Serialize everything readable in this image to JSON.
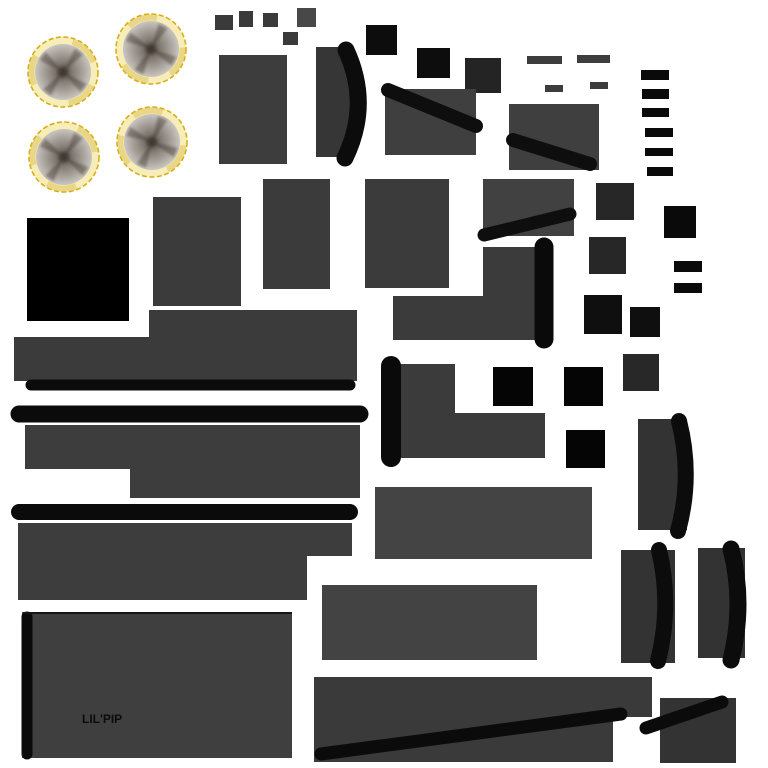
{
  "meta": {
    "width": 768,
    "height": 768,
    "background": "#ffffff"
  },
  "label": {
    "text": "LIL'PIP",
    "x": 82,
    "y": 713,
    "color": "#0c0c0c"
  },
  "palette": {
    "panel_gray": "#3b3b3b",
    "panel_gray_light": "#444444",
    "panel_gray_dark": "#333333",
    "black": "#0a0a0a",
    "pure_black": "#000000",
    "rim_yellow": "#d9ae14",
    "rim_cream": "#f6edb9",
    "rim_gold": "#dfc35e"
  },
  "wheel_style": {
    "rim_stroke": "#d9ae14",
    "rim_fill": "#f6edb9",
    "rim_shade": "#dfc35e",
    "spoke": "rgba(56,46,40,0.42)",
    "hub": "rgba(58,48,40,0.85)",
    "disc_stops": [
      [
        "0%",
        "#68615a"
      ],
      [
        "38%",
        "#867f78"
      ],
      [
        "72%",
        "#aaa49e"
      ],
      [
        "100%",
        "#c9c5c0"
      ]
    ]
  },
  "wheels": [
    {
      "cx": 63,
      "cy": 72,
      "r": 35,
      "spoke_rot": 38
    },
    {
      "cx": 151,
      "cy": 49,
      "r": 35,
      "spoke_rot": 28
    },
    {
      "cx": 64,
      "cy": 157,
      "r": 35,
      "spoke_rot": 34
    },
    {
      "cx": 152,
      "cy": 142,
      "r": 35,
      "spoke_rot": 24
    }
  ],
  "rects": [
    {
      "name": "chip-square-1",
      "x": 215,
      "y": 15,
      "w": 18,
      "h": 15,
      "color": "#3a3a3a"
    },
    {
      "name": "chip-square-2",
      "x": 239,
      "y": 11,
      "w": 14,
      "h": 16,
      "color": "#3a3a3a"
    },
    {
      "name": "chip-square-3",
      "x": 263,
      "y": 13,
      "w": 15,
      "h": 14,
      "color": "#3a3a3a"
    },
    {
      "name": "chip-square-4",
      "x": 297,
      "y": 8,
      "w": 19,
      "h": 19,
      "color": "#484848"
    },
    {
      "name": "chip-square-5",
      "x": 283,
      "y": 32,
      "w": 15,
      "h": 13,
      "color": "#3a3a3a"
    },
    {
      "name": "panel-a",
      "x": 219,
      "y": 55,
      "w": 68,
      "h": 109,
      "color": "#3d3d3d"
    },
    {
      "name": "crescent-b-body",
      "x": 316,
      "y": 47,
      "w": 37,
      "h": 110,
      "color": "#363636"
    },
    {
      "name": "black-square-c1",
      "x": 366,
      "y": 25,
      "w": 31,
      "h": 30,
      "color": "#0d0d0d"
    },
    {
      "name": "black-square-c2",
      "x": 417,
      "y": 48,
      "w": 33,
      "h": 30,
      "color": "#0d0d0d"
    },
    {
      "name": "dark-square-c3",
      "x": 465,
      "y": 58,
      "w": 36,
      "h": 35,
      "color": "#242424"
    },
    {
      "name": "panel-d",
      "x": 385,
      "y": 89,
      "w": 91,
      "h": 66,
      "color": "#3f3f3f"
    },
    {
      "name": "panel-e",
      "x": 509,
      "y": 104,
      "w": 90,
      "h": 66,
      "color": "#3f3f3f"
    },
    {
      "name": "thin-bar-1",
      "x": 527,
      "y": 56,
      "w": 35,
      "h": 8,
      "color": "#3d3d3d"
    },
    {
      "name": "thin-bar-2",
      "x": 577,
      "y": 55,
      "w": 33,
      "h": 8,
      "color": "#3d3d3d"
    },
    {
      "name": "thin-bar-3",
      "x": 545,
      "y": 85,
      "w": 18,
      "h": 7,
      "color": "#3d3d3d"
    },
    {
      "name": "thin-bar-4",
      "x": 590,
      "y": 82,
      "w": 18,
      "h": 7,
      "color": "#3d3d3d"
    },
    {
      "name": "vent-bar-1",
      "x": 641,
      "y": 70,
      "w": 28,
      "h": 10,
      "color": "#0a0a0a"
    },
    {
      "name": "vent-bar-2",
      "x": 642,
      "y": 89,
      "w": 27,
      "h": 10,
      "color": "#0a0a0a"
    },
    {
      "name": "vent-bar-3",
      "x": 642,
      "y": 108,
      "w": 27,
      "h": 9,
      "color": "#0a0a0a"
    },
    {
      "name": "vent-bar-4",
      "x": 645,
      "y": 128,
      "w": 28,
      "h": 9,
      "color": "#0a0a0a"
    },
    {
      "name": "vent-bar-5",
      "x": 645,
      "y": 148,
      "w": 28,
      "h": 8,
      "color": "#0a0a0a"
    },
    {
      "name": "vent-bar-6",
      "x": 647,
      "y": 167,
      "w": 26,
      "h": 9,
      "color": "#0a0a0a"
    },
    {
      "name": "black-square-f",
      "x": 664,
      "y": 206,
      "w": 32,
      "h": 32,
      "color": "#0a0a0a"
    },
    {
      "name": "panel-i1",
      "x": 153,
      "y": 197,
      "w": 88,
      "h": 109,
      "color": "#3b3b3b"
    },
    {
      "name": "panel-i2",
      "x": 263,
      "y": 179,
      "w": 67,
      "h": 110,
      "color": "#3b3b3b"
    },
    {
      "name": "panel-i3",
      "x": 365,
      "y": 179,
      "w": 84,
      "h": 109,
      "color": "#3b3b3b"
    },
    {
      "name": "panel-i4",
      "x": 483,
      "y": 179,
      "w": 91,
      "h": 57,
      "color": "#414141"
    },
    {
      "name": "big-black-square",
      "x": 27,
      "y": 218,
      "w": 102,
      "h": 103,
      "color": "#000000"
    },
    {
      "name": "dark-square-l1",
      "x": 596,
      "y": 183,
      "w": 38,
      "h": 37,
      "color": "#272727"
    },
    {
      "name": "dark-square-l2",
      "x": 589,
      "y": 237,
      "w": 37,
      "h": 37,
      "color": "#272727"
    },
    {
      "name": "small-bar-r1",
      "x": 674,
      "y": 261,
      "w": 28,
      "h": 11,
      "color": "#0a0a0a"
    },
    {
      "name": "small-bar-r2",
      "x": 674,
      "y": 283,
      "w": 28,
      "h": 10,
      "color": "#0a0a0a"
    },
    {
      "name": "black-square-l3",
      "x": 584,
      "y": 295,
      "w": 38,
      "h": 39,
      "color": "#0f0f0f"
    },
    {
      "name": "black-square-l4",
      "x": 630,
      "y": 307,
      "w": 30,
      "h": 30,
      "color": "#0f0f0f"
    },
    {
      "name": "dark-square-l5",
      "x": 623,
      "y": 354,
      "w": 36,
      "h": 37,
      "color": "#282828"
    },
    {
      "name": "black-square-m1",
      "x": 493,
      "y": 367,
      "w": 40,
      "h": 39,
      "color": "#050505"
    },
    {
      "name": "black-square-m2",
      "x": 564,
      "y": 367,
      "w": 39,
      "h": 39,
      "color": "#050505"
    },
    {
      "name": "black-square-m3",
      "x": 566,
      "y": 430,
      "w": 39,
      "h": 38,
      "color": "#050505"
    },
    {
      "name": "panel-u",
      "x": 375,
      "y": 487,
      "w": 217,
      "h": 72,
      "color": "#444444"
    },
    {
      "name": "panel-v",
      "x": 322,
      "y": 585,
      "w": 215,
      "h": 75,
      "color": "#434343"
    },
    {
      "name": "panel-y",
      "x": 22,
      "y": 612,
      "w": 270,
      "h": 146,
      "color": "#3f3f3f"
    },
    {
      "name": "crescent-x1-body",
      "x": 638,
      "y": 419,
      "w": 49,
      "h": 111,
      "color": "#333333"
    },
    {
      "name": "crescent-x2-body",
      "x": 621,
      "y": 550,
      "w": 54,
      "h": 113,
      "color": "#333333"
    },
    {
      "name": "crescent-x3-body",
      "x": 698,
      "y": 548,
      "w": 47,
      "h": 110,
      "color": "#333333"
    },
    {
      "name": "panel-aa",
      "x": 660,
      "y": 698,
      "w": 76,
      "h": 65,
      "color": "#333333"
    }
  ],
  "polygons": [
    {
      "name": "bracket-k",
      "points": "483,247 535,247 535,340 393,340 393,296 483,296",
      "color": "#3b3b3b"
    },
    {
      "name": "step-panel-n",
      "points": "149,310 357,310 357,381 14,381 14,337 149,337",
      "color": "#3b3b3b"
    },
    {
      "name": "step-panel-p",
      "points": "25,425 360,425 360,498 130,498 130,469 25,469",
      "color": "#3d3d3d"
    },
    {
      "name": "step-panel-r",
      "points": "18,523 352,523 352,556 307,556 307,600 18,600",
      "color": "#3d3d3d"
    },
    {
      "name": "step-panel-t",
      "points": "389,364 455,364 455,413 545,413 545,458 389,458",
      "color": "#3b3b3b"
    },
    {
      "name": "step-panel-z",
      "points": "314,677 652,677 652,717 613,717 613,762 314,762",
      "color": "#3a3a3a"
    }
  ],
  "capsules": [
    {
      "name": "edge-bar-n",
      "x1": 31,
      "y1": 385,
      "x2": 350,
      "y2": 385,
      "w": 11,
      "color": "#0b0b0b"
    },
    {
      "name": "long-bar-o",
      "x1": 19,
      "y1": 414,
      "x2": 360,
      "y2": 414,
      "w": 17,
      "color": "#0b0b0b"
    },
    {
      "name": "long-bar-q",
      "x1": 19,
      "y1": 512,
      "x2": 350,
      "y2": 512,
      "w": 16,
      "color": "#0b0b0b"
    },
    {
      "name": "capsule-k",
      "x1": 544,
      "y1": 247,
      "x2": 544,
      "y2": 339,
      "w": 19,
      "color": "#0a0a0a"
    },
    {
      "name": "capsule-s",
      "x1": 391,
      "y1": 366,
      "x2": 391,
      "y2": 457,
      "w": 20,
      "color": "#0a0a0a"
    },
    {
      "name": "diagonal-bar-d",
      "x1": 388,
      "y1": 90,
      "x2": 476,
      "y2": 126,
      "w": 14,
      "color": "#0e0e0e"
    },
    {
      "name": "diagonal-bar-e",
      "x1": 513,
      "y1": 140,
      "x2": 590,
      "y2": 164,
      "w": 14,
      "color": "#0e0e0e"
    },
    {
      "name": "diagonal-bar-i4",
      "x1": 484,
      "y1": 235,
      "x2": 570,
      "y2": 214,
      "w": 13,
      "color": "#0e0e0e"
    },
    {
      "name": "panel-y-left-edge",
      "x1": 27,
      "y1": 617,
      "x2": 27,
      "y2": 754,
      "w": 11,
      "color": "#0a0a0a"
    },
    {
      "name": "panel-y-top-line",
      "x1": 24,
      "y1": 613,
      "x2": 291,
      "y2": 613,
      "w": 2,
      "color": "#151515"
    },
    {
      "name": "diagonal-bar-z",
      "x1": 321,
      "y1": 754,
      "x2": 621,
      "y2": 714,
      "w": 13,
      "color": "#0b0b0b"
    },
    {
      "name": "diagonal-bar-aa",
      "x1": 646,
      "y1": 728,
      "x2": 722,
      "y2": 702,
      "w": 13,
      "color": "#0b0b0b"
    }
  ],
  "curves": [
    {
      "name": "crescent-b-band",
      "d": "M 346 50 Q 371 104 345 158",
      "w": 17,
      "color": "#0c0c0c"
    },
    {
      "name": "crescent-x1-band",
      "d": "M 679 421 Q 693 476 678 531",
      "w": 16,
      "color": "#0c0c0c"
    },
    {
      "name": "crescent-x2-band",
      "d": "M 659 550 Q 672 605 658 661",
      "w": 16,
      "color": "#0c0c0c"
    },
    {
      "name": "crescent-x3-band",
      "d": "M 731 549 Q 745 603 731 660",
      "w": 17,
      "color": "#0c0c0c"
    }
  ]
}
